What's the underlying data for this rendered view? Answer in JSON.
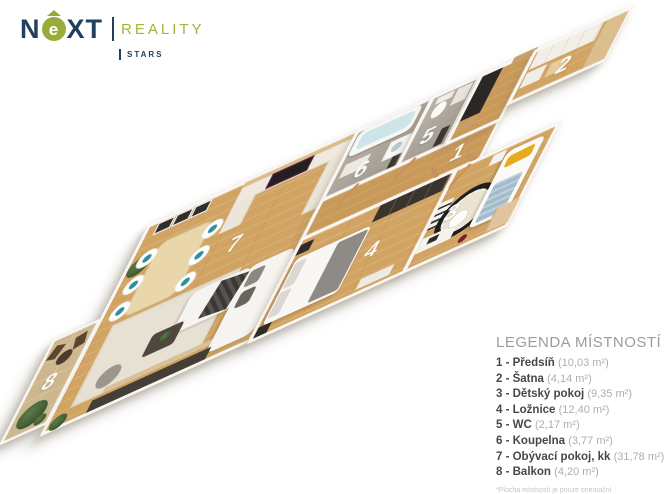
{
  "logo": {
    "n": "N",
    "e": "e",
    "xt": "XT",
    "reality": "REALITY",
    "stars": "STARS",
    "navy": "#21405f",
    "green": "#98ac3b"
  },
  "watermark": {
    "text": "NEXT"
  },
  "plan": {
    "rooms": [
      {
        "number": "1",
        "name": "Předsíň"
      },
      {
        "number": "2",
        "name": "Šatna"
      },
      {
        "number": "3",
        "name": "Dětský pokoj"
      },
      {
        "number": "4",
        "name": "Ložnice"
      },
      {
        "number": "5",
        "name": "WC"
      },
      {
        "number": "6",
        "name": "Koupelna"
      },
      {
        "number": "7",
        "name": "Obývací pokoj, kk"
      },
      {
        "number": "8",
        "name": "Balkon"
      }
    ],
    "floor_color": "#d2a463",
    "wall_color": "#f9f7f3"
  },
  "legend": {
    "title": "LEGENDA MÍSTNOSTÍ",
    "items": [
      {
        "name_full": "1 - Předsíň ",
        "area": "(10,03 m²)"
      },
      {
        "name_full": "2 - Šatna ",
        "area": "(4,14 m²)"
      },
      {
        "name_full": "3 - Dětský pokoj ",
        "area": "(9,35 m²)"
      },
      {
        "name_full": "4 - Ložnice ",
        "area": "(12,40 m²)"
      },
      {
        "name_full": "5 - WC ",
        "area": "(2,17 m²)"
      },
      {
        "name_full": "6 - Koupelna ",
        "area": "(3,77 m²)"
      },
      {
        "name_full": "7 - Obývací pokoj, kk ",
        "area": "(31,78 m²)"
      },
      {
        "name_full": "8 - Balkon ",
        "area": "(4,20 m²)"
      }
    ],
    "footnote": "*Plocha místností je pouze orientační"
  }
}
